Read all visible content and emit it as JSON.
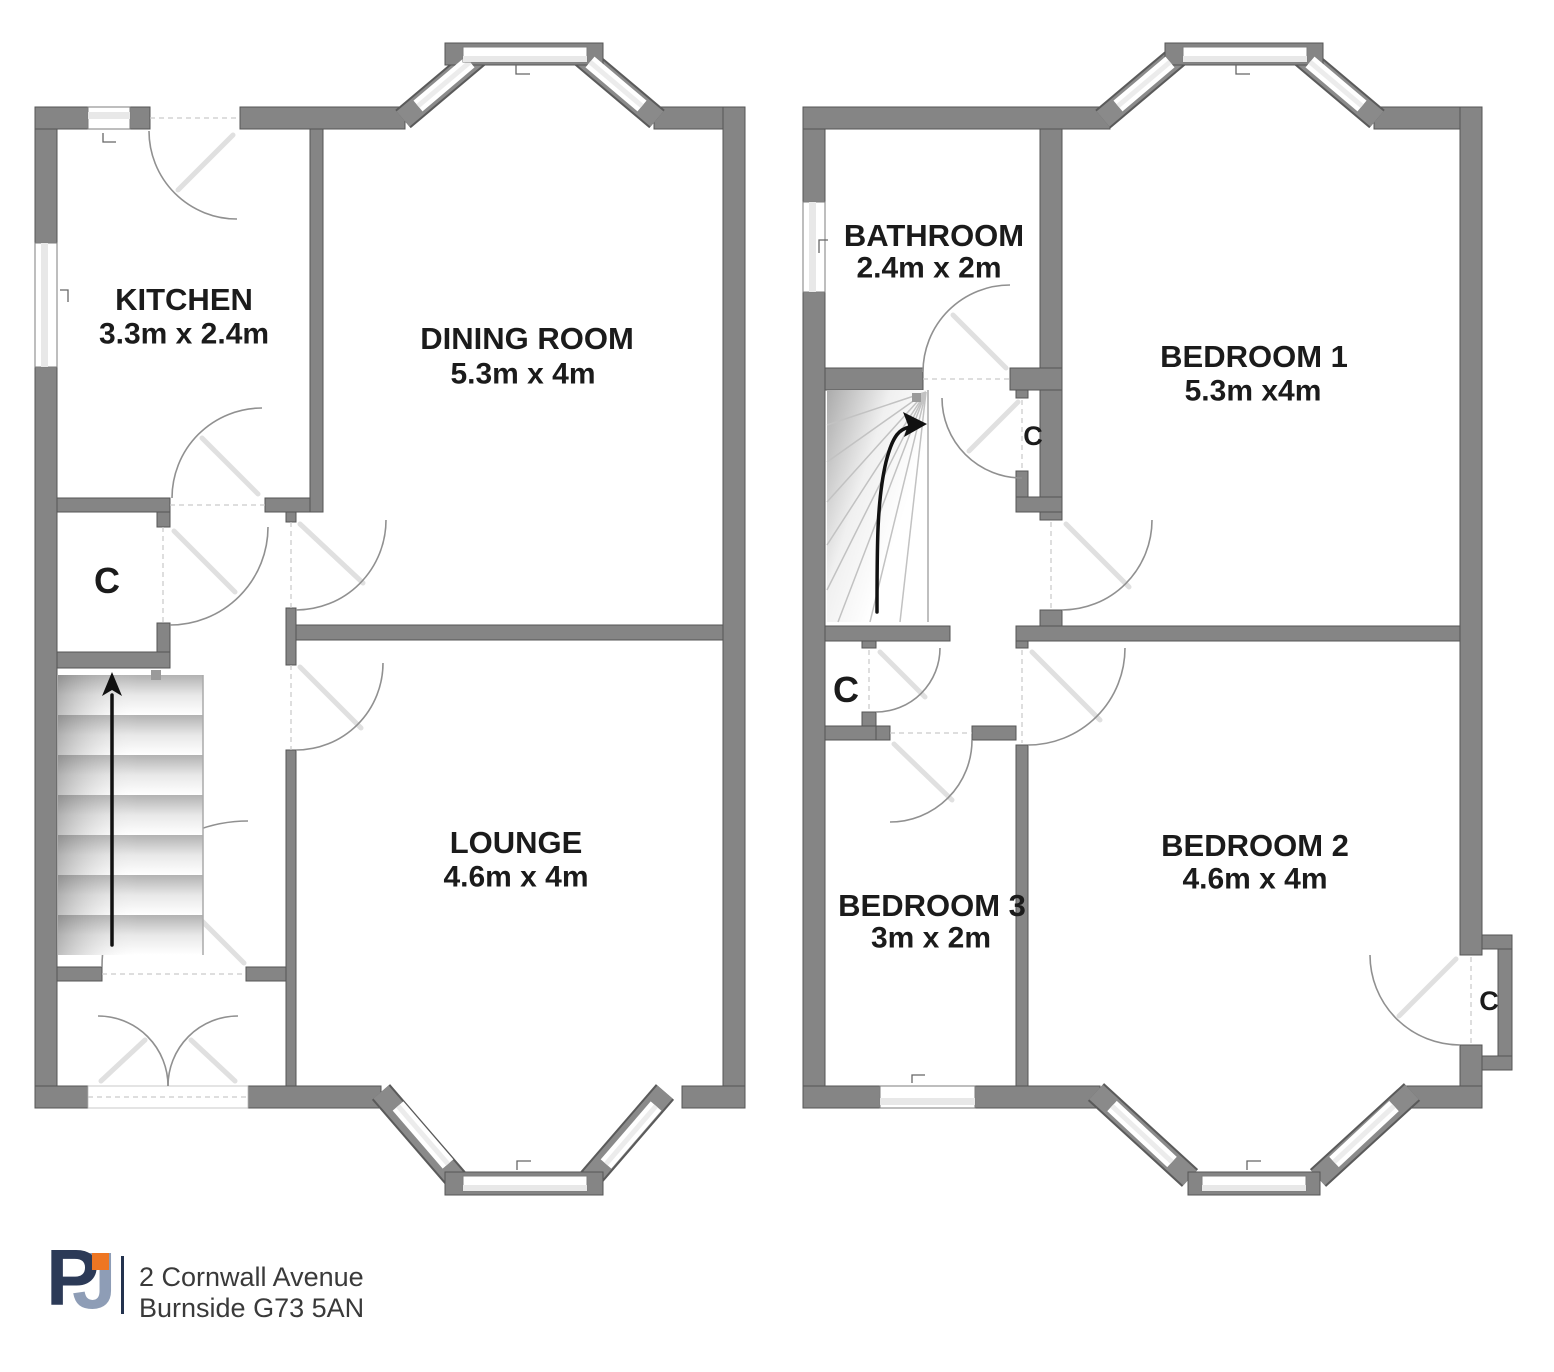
{
  "floors": {
    "ground": {
      "rooms": [
        {
          "id": "kitchen",
          "name": "KITCHEN",
          "dims": "3.3m x 2.4m"
        },
        {
          "id": "dining",
          "name": "DINING ROOM",
          "dims": "5.3m x 4m"
        },
        {
          "id": "lounge",
          "name": "LOUNGE",
          "dims": "4.6m x 4m"
        }
      ],
      "closet_label": "C"
    },
    "first": {
      "rooms": [
        {
          "id": "bathroom",
          "name": "BATHROOM",
          "dims": "2.4m x 2m"
        },
        {
          "id": "bedroom1",
          "name": "BEDROOM 1",
          "dims": "5.3m x4m"
        },
        {
          "id": "bedroom2",
          "name": "BEDROOM 2",
          "dims": "4.6m x 4m"
        },
        {
          "id": "bedroom3",
          "name": "BEDROOM 3",
          "dims": "3m x 2m"
        }
      ],
      "closet_labels": {
        "landing": "C",
        "under_stairs": "C",
        "bedroom2": "C"
      }
    }
  },
  "footer": {
    "logo": {
      "letter_p": "P",
      "letter_j": "J"
    },
    "address_line1": "2 Cornwall Avenue",
    "address_line2": "Burnside G73 5AN"
  },
  "colors": {
    "wall": "#858585",
    "glazing": "#e8e8e8",
    "door_arc": "#909090",
    "logo_navy": "#2c3a57",
    "logo_steel": "#8e9db6",
    "logo_orange": "#ee7623",
    "text": "#1b1b1b"
  }
}
